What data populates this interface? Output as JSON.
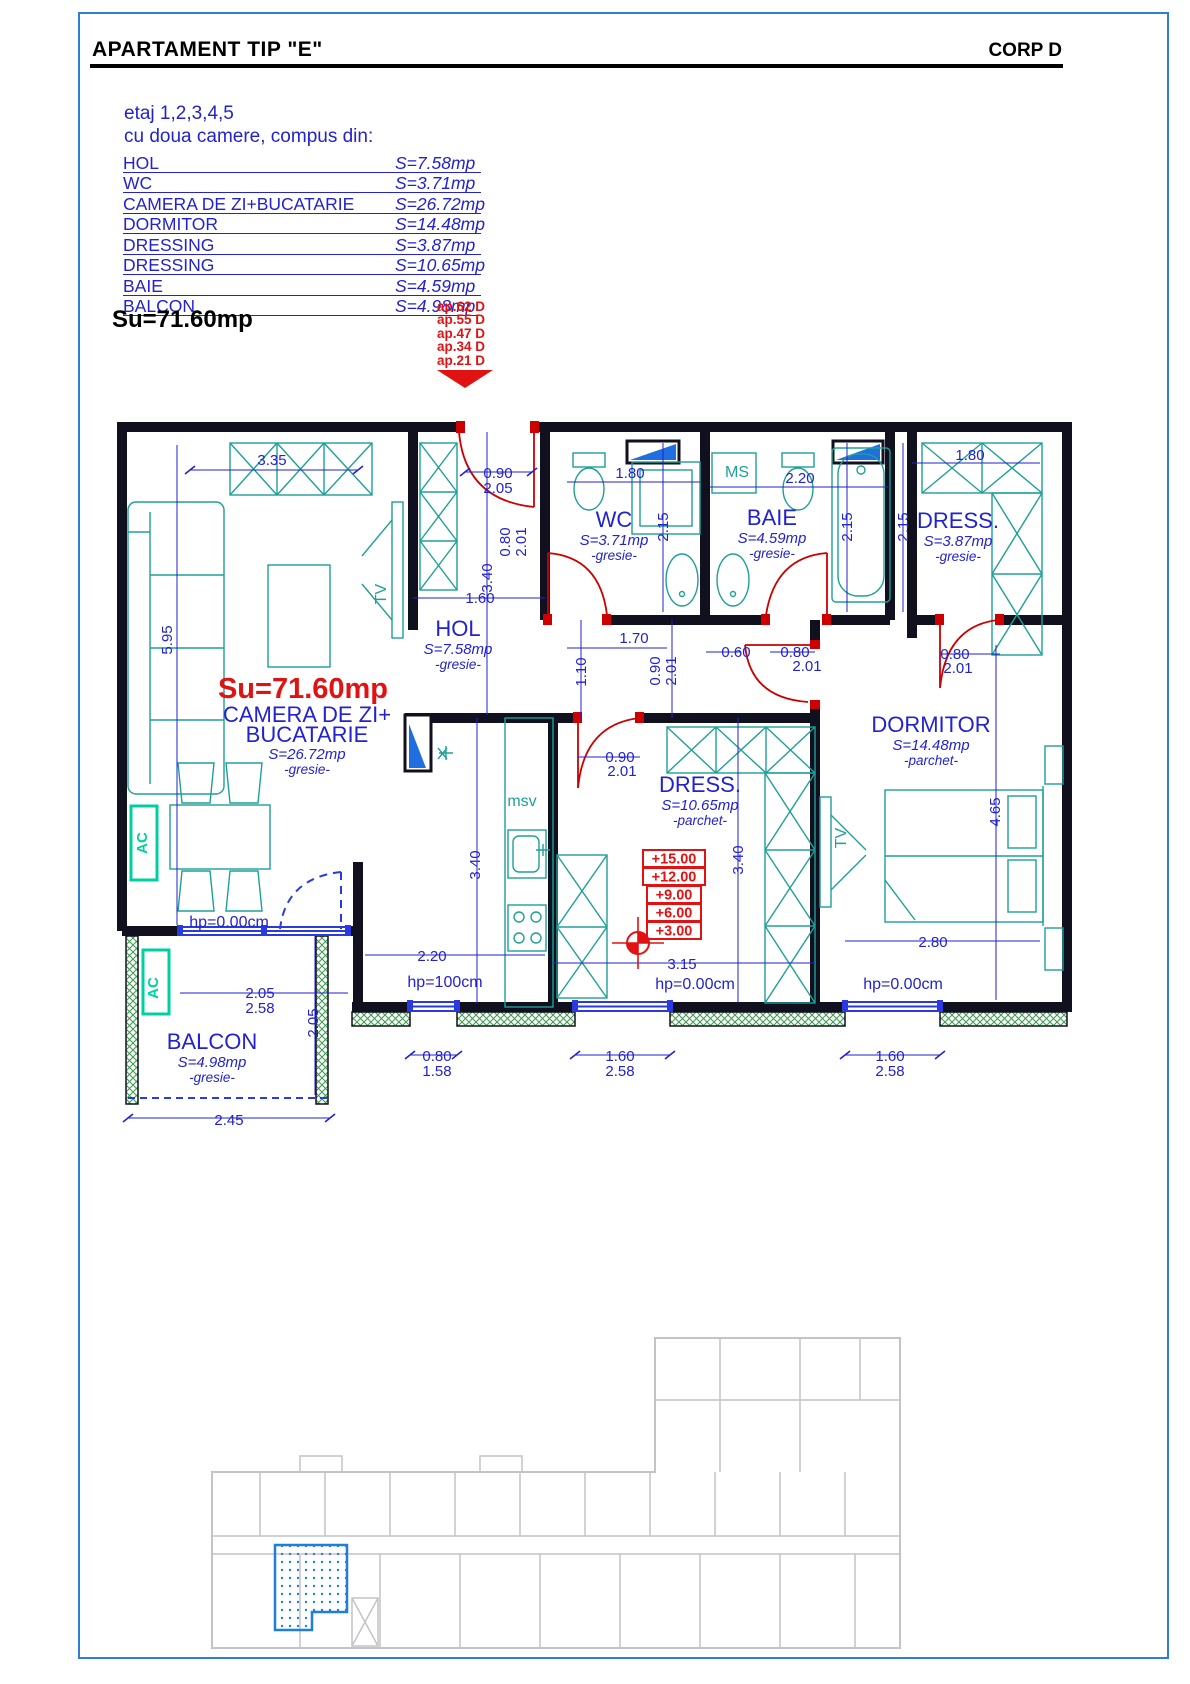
{
  "header": {
    "title": "APARTAMENT TIP \"E\"",
    "corp": "CORP D"
  },
  "info": {
    "line1": "etaj 1,2,3,4,5",
    "line2": "cu doua camere, compus din:"
  },
  "room_table": [
    {
      "name": "HOL",
      "area": "S=7.58mp"
    },
    {
      "name": "WC",
      "area": "S=3.71mp"
    },
    {
      "name": "CAMERA DE ZI+BUCATARIE",
      "area": "S=26.72mp"
    },
    {
      "name": "DORMITOR",
      "area": "S=14.48mp"
    },
    {
      "name": "DRESSING",
      "area": "S=3.87mp"
    },
    {
      "name": "DRESSING",
      "area": "S=10.65mp"
    },
    {
      "name": "BAIE",
      "area": "S=4.59mp"
    },
    {
      "name": "BALCON",
      "area": "S=4.98mp"
    }
  ],
  "total_area_label": "Su=71.60mp",
  "apartment_labels": [
    "ap.62 D",
    "ap.55 D",
    "ap.47 D",
    "ap.34 D",
    "ap.21 D"
  ],
  "plan": {
    "levels": [
      "+15.00",
      "+12.00",
      "+9.00",
      "+6.00",
      "+3.00"
    ],
    "texts": [
      {
        "t": "HOL",
        "x": 458,
        "y": 636,
        "c": "rn"
      },
      {
        "t": "S=7.58mp",
        "x": 458,
        "y": 654,
        "c": "ra"
      },
      {
        "t": "-gresie-",
        "x": 458,
        "y": 669,
        "c": "rf"
      },
      {
        "t": "WC",
        "x": 614,
        "y": 527,
        "c": "rn"
      },
      {
        "t": "S=3.71mp",
        "x": 614,
        "y": 545,
        "c": "ra"
      },
      {
        "t": "-gresie-",
        "x": 614,
        "y": 560,
        "c": "rf"
      },
      {
        "t": "BAIE",
        "x": 772,
        "y": 525,
        "c": "rn"
      },
      {
        "t": "S=4.59mp",
        "x": 772,
        "y": 543,
        "c": "ra"
      },
      {
        "t": "-gresie-",
        "x": 772,
        "y": 558,
        "c": "rf"
      },
      {
        "t": "MS",
        "x": 737,
        "y": 477,
        "c": "teal"
      },
      {
        "t": "DRESS.",
        "x": 958,
        "y": 528,
        "c": "rn"
      },
      {
        "t": "S=3.87mp",
        "x": 958,
        "y": 546,
        "c": "ra"
      },
      {
        "t": "-gresie-",
        "x": 958,
        "y": 561,
        "c": "rf"
      },
      {
        "t": "DORMITOR",
        "x": 931,
        "y": 732,
        "c": "rn"
      },
      {
        "t": "S=14.48mp",
        "x": 931,
        "y": 750,
        "c": "ra"
      },
      {
        "t": "-parchet-",
        "x": 931,
        "y": 765,
        "c": "rf"
      },
      {
        "t": "DRESS.",
        "x": 700,
        "y": 792,
        "c": "rn"
      },
      {
        "t": "S=10.65mp",
        "x": 700,
        "y": 810,
        "c": "ra"
      },
      {
        "t": "-parchet-",
        "x": 700,
        "y": 825,
        "c": "rf"
      },
      {
        "t": "Su=71.60mp",
        "x": 303,
        "y": 698,
        "c": "su"
      },
      {
        "t": "CAMERA DE ZI+",
        "x": 307,
        "y": 722,
        "c": "rn"
      },
      {
        "t": "BUCATARIE",
        "x": 307,
        "y": 742,
        "c": "rn"
      },
      {
        "t": "S=26.72mp",
        "x": 307,
        "y": 759,
        "c": "ra"
      },
      {
        "t": "-gresie-",
        "x": 307,
        "y": 774,
        "c": "rf"
      },
      {
        "t": "BALCON",
        "x": 212,
        "y": 1049,
        "c": "rn"
      },
      {
        "t": "S=4.98mp",
        "x": 212,
        "y": 1067,
        "c": "ra"
      },
      {
        "t": "-gresie-",
        "x": 212,
        "y": 1082,
        "c": "rf"
      },
      {
        "t": "msv",
        "x": 522,
        "y": 806,
        "c": "teal"
      },
      {
        "t": "TV",
        "x": 386,
        "y": 594,
        "c": "teal",
        "r": -90
      },
      {
        "t": "TV",
        "x": 846,
        "y": 838,
        "c": "teal",
        "r": -90
      },
      {
        "t": "AC",
        "x": 147,
        "y": 843,
        "c": "ac",
        "r": -90
      },
      {
        "t": "AC",
        "x": 158,
        "y": 988,
        "c": "ac",
        "r": -90
      },
      {
        "t": "3.35",
        "x": 272,
        "y": 465,
        "c": "dim"
      },
      {
        "t": "0.90",
        "x": 498,
        "y": 478,
        "c": "dim"
      },
      {
        "t": "2.05",
        "x": 498,
        "y": 493,
        "c": "dim"
      },
      {
        "t": "1.80",
        "x": 630,
        "y": 478,
        "c": "dim"
      },
      {
        "t": "2.20",
        "x": 800,
        "y": 483,
        "c": "dim"
      },
      {
        "t": "1.80",
        "x": 970,
        "y": 460,
        "c": "dim"
      },
      {
        "t": "2.15",
        "x": 668,
        "y": 527,
        "c": "dim",
        "r": -90
      },
      {
        "t": "2.15",
        "x": 852,
        "y": 527,
        "c": "dim",
        "r": -90
      },
      {
        "t": "2.15",
        "x": 908,
        "y": 527,
        "c": "dim",
        "r": -90
      },
      {
        "t": "0.80",
        "x": 510,
        "y": 542,
        "c": "dim",
        "r": -90
      },
      {
        "t": "2.01",
        "x": 526,
        "y": 542,
        "c": "dim",
        "r": -90
      },
      {
        "t": "3.40",
        "x": 492,
        "y": 578,
        "c": "dim",
        "r": -90
      },
      {
        "t": "1.60",
        "x": 480,
        "y": 603,
        "c": "dim"
      },
      {
        "t": "5.95",
        "x": 172,
        "y": 640,
        "c": "dim",
        "r": -90
      },
      {
        "t": "1.70",
        "x": 634,
        "y": 643,
        "c": "dim"
      },
      {
        "t": "1.10",
        "x": 586,
        "y": 672,
        "c": "dim",
        "r": -90
      },
      {
        "t": "0.90",
        "x": 660,
        "y": 671,
        "c": "dim",
        "r": -90
      },
      {
        "t": "2.01",
        "x": 676,
        "y": 671,
        "c": "dim",
        "r": -90
      },
      {
        "t": "0.60",
        "x": 736,
        "y": 657,
        "c": "dim"
      },
      {
        "t": "0.80",
        "x": 795,
        "y": 657,
        "c": "dim"
      },
      {
        "t": "2.01",
        "x": 807,
        "y": 671,
        "c": "dim"
      },
      {
        "t": "0.80",
        "x": 955,
        "y": 659,
        "c": "dim"
      },
      {
        "t": "2.01",
        "x": 958,
        "y": 673,
        "c": "dim"
      },
      {
        "t": "4.65",
        "x": 1000,
        "y": 812,
        "c": "dim",
        "r": -90
      },
      {
        "t": "0.90",
        "x": 620,
        "y": 762,
        "c": "dim"
      },
      {
        "t": "2.01",
        "x": 622,
        "y": 776,
        "c": "dim"
      },
      {
        "t": "3.40",
        "x": 480,
        "y": 865,
        "c": "dim",
        "r": -90
      },
      {
        "t": "3.40",
        "x": 743,
        "y": 860,
        "c": "dim",
        "r": -90
      },
      {
        "t": "2.20",
        "x": 432,
        "y": 961,
        "c": "dim"
      },
      {
        "t": "hp=100cm",
        "x": 445,
        "y": 987,
        "c": "hp"
      },
      {
        "t": "3.15",
        "x": 682,
        "y": 969,
        "c": "dim"
      },
      {
        "t": "hp=0.00cm",
        "x": 695,
        "y": 989,
        "c": "hp"
      },
      {
        "t": "2.80",
        "x": 933,
        "y": 947,
        "c": "dim"
      },
      {
        "t": "hp=0.00cm",
        "x": 903,
        "y": 989,
        "c": "hp"
      },
      {
        "t": "hp=0.00cm",
        "x": 229,
        "y": 927,
        "c": "hp"
      },
      {
        "t": "2.05",
        "x": 260,
        "y": 998,
        "c": "dim"
      },
      {
        "t": "2.58",
        "x": 260,
        "y": 1013,
        "c": "dim"
      },
      {
        "t": "2.05",
        "x": 318,
        "y": 1023,
        "c": "dim",
        "r": -90
      },
      {
        "t": "0.80",
        "x": 437,
        "y": 1061,
        "c": "dim"
      },
      {
        "t": "1.58",
        "x": 437,
        "y": 1076,
        "c": "dim"
      },
      {
        "t": "1.60",
        "x": 620,
        "y": 1061,
        "c": "dim"
      },
      {
        "t": "2.58",
        "x": 620,
        "y": 1076,
        "c": "dim"
      },
      {
        "t": "1.60",
        "x": 890,
        "y": 1061,
        "c": "dim"
      },
      {
        "t": "2.58",
        "x": 890,
        "y": 1076,
        "c": "dim"
      },
      {
        "t": "2.45",
        "x": 229,
        "y": 1125,
        "c": "dim"
      }
    ]
  },
  "colors": {
    "annotation_blue": "#2222cf",
    "door_red": "#cc0000",
    "marker_red": "#e01212",
    "furniture_teal": "#1fa096",
    "ac_green": "#00d0a0",
    "wall_black": "#10101e",
    "window_blue": "#2a3ae0",
    "page_border_blue": "#2e7fd0",
    "keyplan_grey": "#c3c3c9",
    "hatch_green": "#3f9e4f"
  }
}
